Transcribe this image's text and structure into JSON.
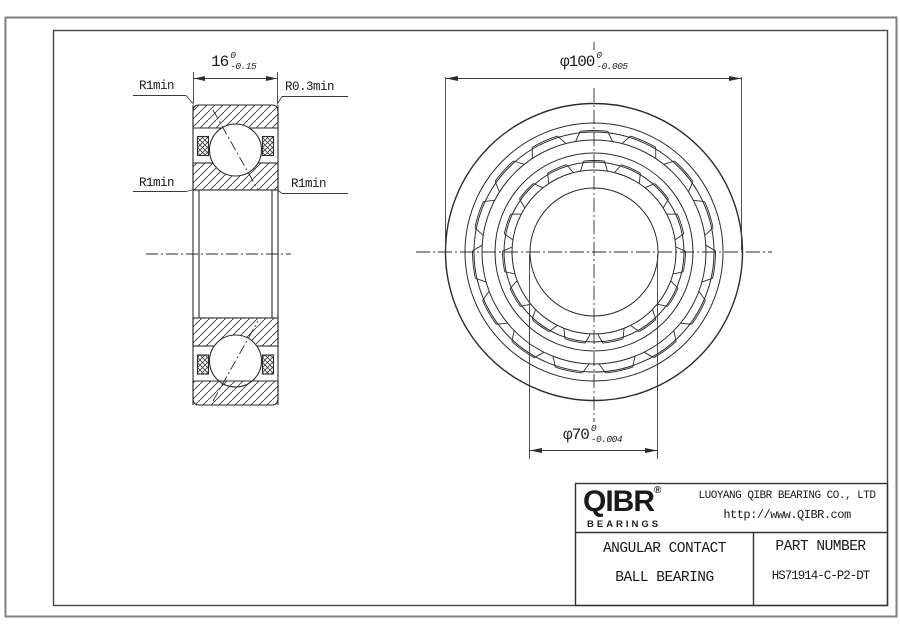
{
  "section_view": {
    "width_dimension": {
      "value": "16",
      "tolerance_upper": "0",
      "tolerance_lower": "-0.15"
    },
    "fillet_labels": {
      "top_left": "R1min",
      "top_right": "R0.3min",
      "mid_left": "R1min",
      "mid_right": "R1min"
    }
  },
  "front_view": {
    "outer_diameter_dimension": {
      "value": "φ100",
      "tolerance_upper": "0",
      "tolerance_lower": "-0.005"
    },
    "bore_diameter_dimension": {
      "value": "φ70",
      "tolerance_upper": "0",
      "tolerance_lower": "-0.004"
    }
  },
  "title_block": {
    "logo_text": "QIBR",
    "logo_registered": "®",
    "logo_subtext": "BEARINGS",
    "company_name": "LUOYANG QIBR BEARING CO., LTD",
    "website": "http://www.QIBR.com",
    "product_type_line1": "ANGULAR CONTACT",
    "product_type_line2": "BALL BEARING",
    "part_number_label": "PART NUMBER",
    "part_number_value": "HS71914-C-P2-DT"
  },
  "colors": {
    "line": "#2b2b2b",
    "frame_outer": "#7f7f7f",
    "frame_inner": "#454545",
    "background": "#ffffff",
    "text": "#1a1a1a"
  }
}
